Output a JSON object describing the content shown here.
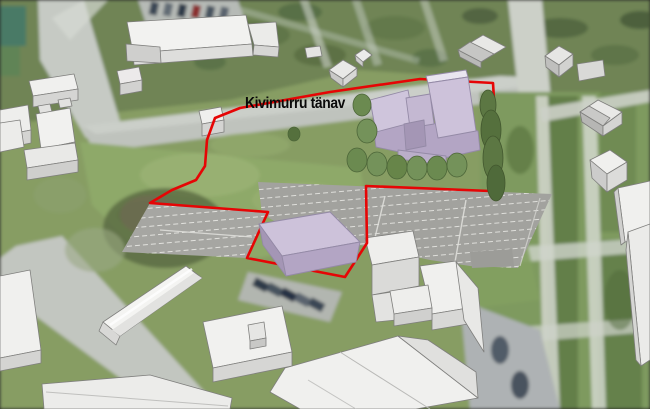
{
  "map": {
    "street_label": "Kivimurru tänav"
  },
  "colors": {
    "parcel_boundary": "#e60505",
    "proposed_building_top": "#cdc2da",
    "proposed_building_side": "#b3a5c4",
    "proposed_building_dark": "#a496b5",
    "model_building_top": "#f1f1ef",
    "model_building_side": "#d6d6d4",
    "grass": "#8aa368",
    "parking": "#a5a5a1",
    "tree_green": "#6b8a50",
    "cypress_green": "#5c7743"
  }
}
